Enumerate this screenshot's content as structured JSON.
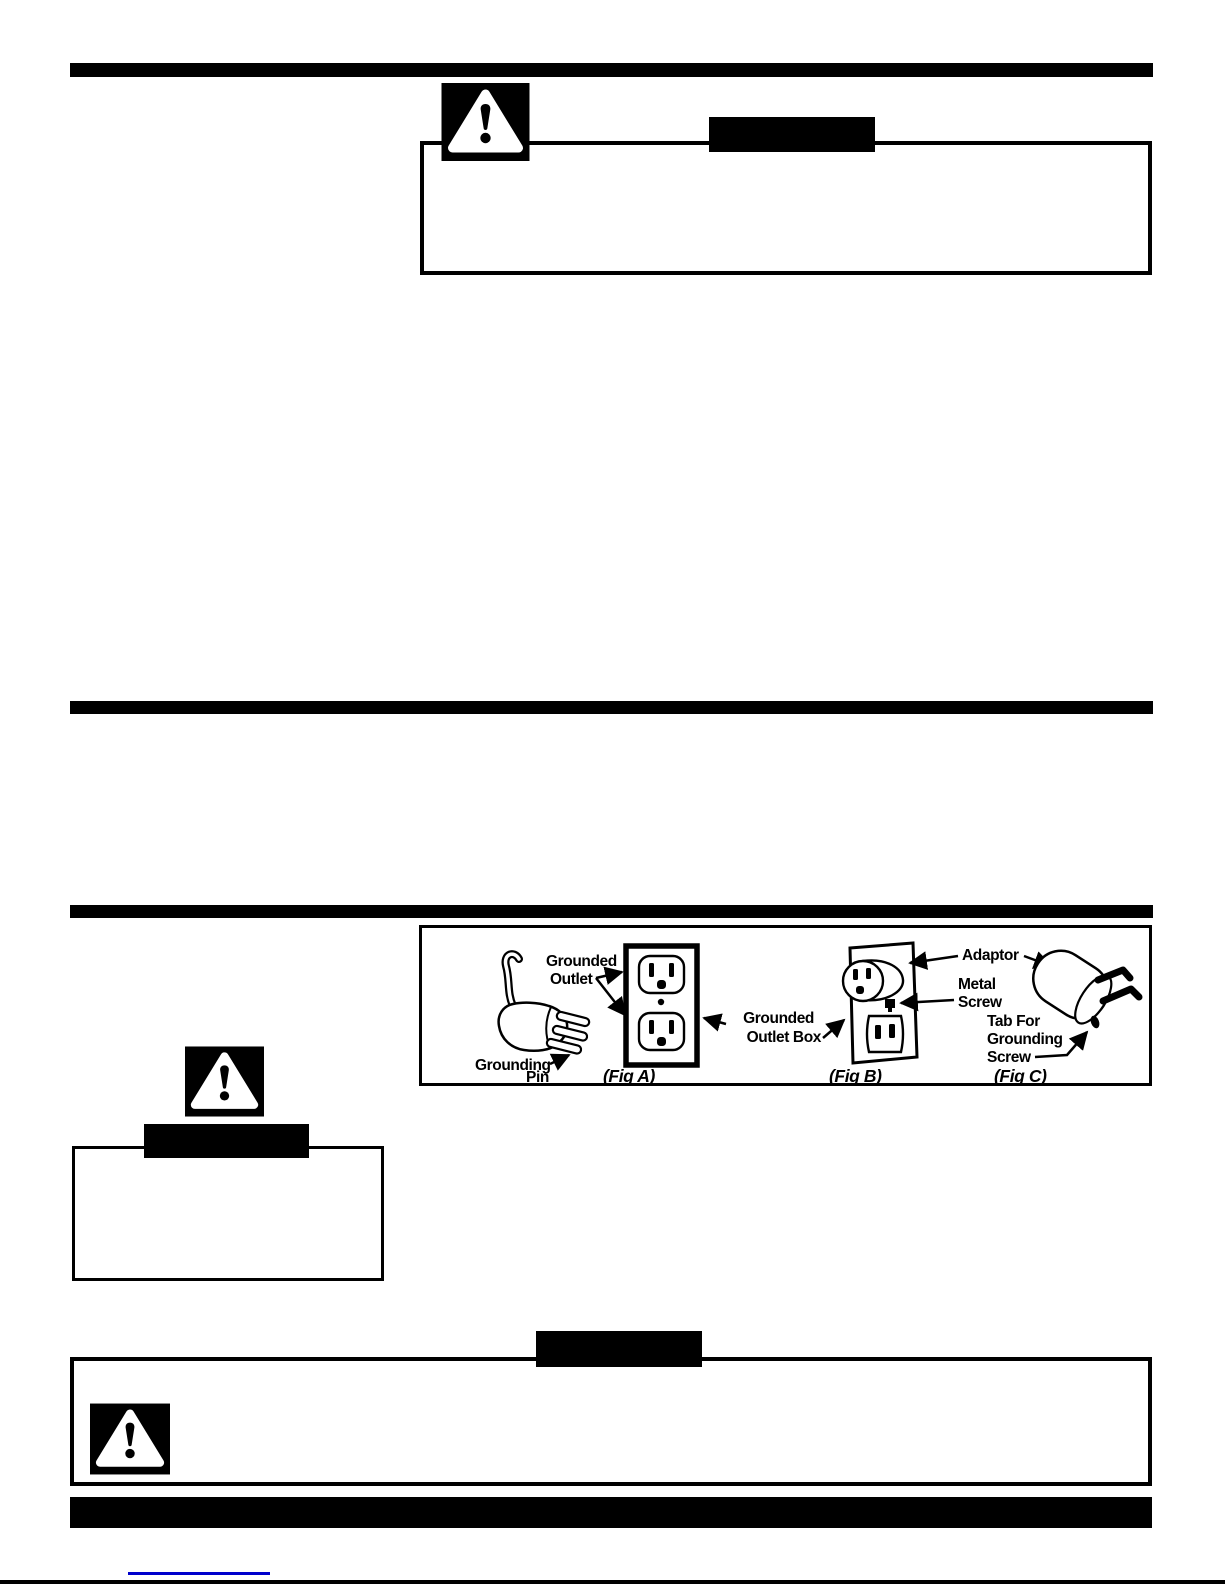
{
  "page": {
    "kind": "scanned-manual-page",
    "colors": {
      "ink": "#000000",
      "paper": "#ffffff",
      "link": "#0000cc"
    }
  },
  "figure": {
    "labels": {
      "grounded_outlet_line1": "Grounded",
      "grounded_outlet_line2": "Outlet",
      "grounding_pin_line1": "Grounding",
      "grounding_pin_line2": "Pin",
      "outlet_box_line1": "Grounded",
      "outlet_box_line2": "Outlet  Box",
      "adaptor": "Adaptor",
      "metal_screw_line1": "Metal",
      "metal_screw_line2": "Screw",
      "tab_line1": "Tab For",
      "tab_line2": "Grounding",
      "tab_line3": "Screw",
      "fig_a": "(Fig A)",
      "fig_b": "(Fig B)",
      "fig_c": "(Fig C)"
    }
  }
}
